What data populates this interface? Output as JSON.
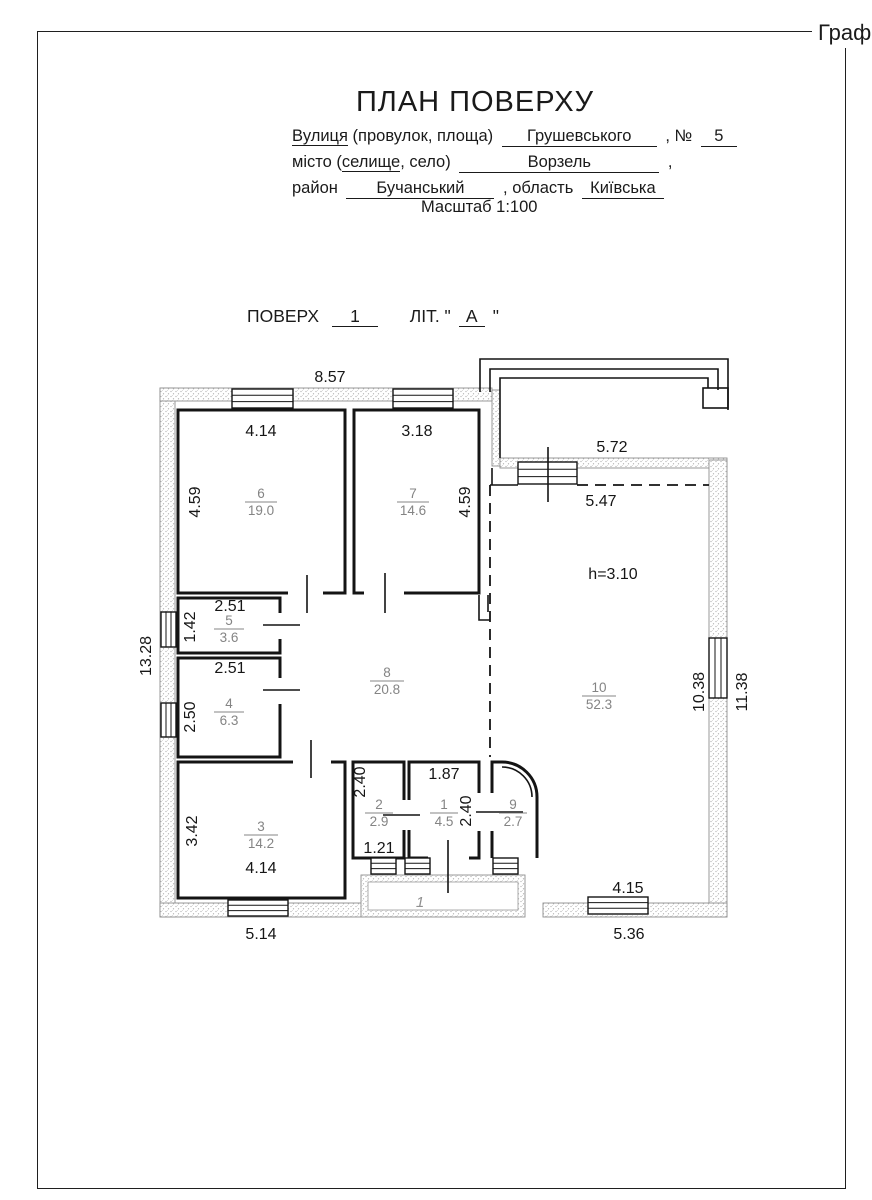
{
  "corner": "Граф:",
  "header": {
    "title": "ПЛАН ПОВЕРХУ",
    "street_word": "Вулиця",
    "street_rest": "(провулок, площа)",
    "street_value": "Грушевського",
    "num_label": ", №",
    "num_value": "5",
    "city_pre": "місто (",
    "city_u": "селище",
    "city_post": ", село)",
    "city_value": "Ворзель",
    "city_comma": ",",
    "district_label": "район",
    "district_value": "Бучанський",
    "region_label": ", область",
    "region_value": "Київська",
    "scale": "Масштаб  1:100"
  },
  "floor": {
    "label": "ПОВЕРХ",
    "value": "1",
    "lit_pre": "ЛІТ. \"",
    "lit_value": "А",
    "lit_post": "\""
  },
  "plan": {
    "height_label": "h=3.10",
    "porch_label": "1",
    "rooms": [
      {
        "n": "1",
        "a": "4.5"
      },
      {
        "n": "2",
        "a": "2.9"
      },
      {
        "n": "3",
        "a": "14.2"
      },
      {
        "n": "4",
        "a": "6.3"
      },
      {
        "n": "5",
        "a": "3.6"
      },
      {
        "n": "6",
        "a": "19.0"
      },
      {
        "n": "7",
        "a": "14.6"
      },
      {
        "n": "8",
        "a": "20.8"
      },
      {
        "n": "9",
        "a": "2.7"
      },
      {
        "n": "10",
        "a": "52.3"
      }
    ],
    "dims": {
      "top": "8.57",
      "room6_w": "4.14",
      "room7_w": "3.18",
      "room6_h": "4.59",
      "room7_h": "4.59",
      "terrace_w": "5.72",
      "room10_top": "5.47",
      "room5_w": "2.51",
      "room5_h": "1.42",
      "room4_w": "2.51",
      "room4_h": "2.50",
      "left": "13.28",
      "room3_h": "3.42",
      "room3_w": "4.14",
      "bottom_left": "5.14",
      "room2_h": "2.40",
      "room2_w": "1.21",
      "room1_w": "1.87",
      "room9_h": "2.40",
      "room10_bottom": "4.15",
      "bottom_right": "5.36",
      "right_inner": "10.38",
      "right": "11.38"
    }
  }
}
